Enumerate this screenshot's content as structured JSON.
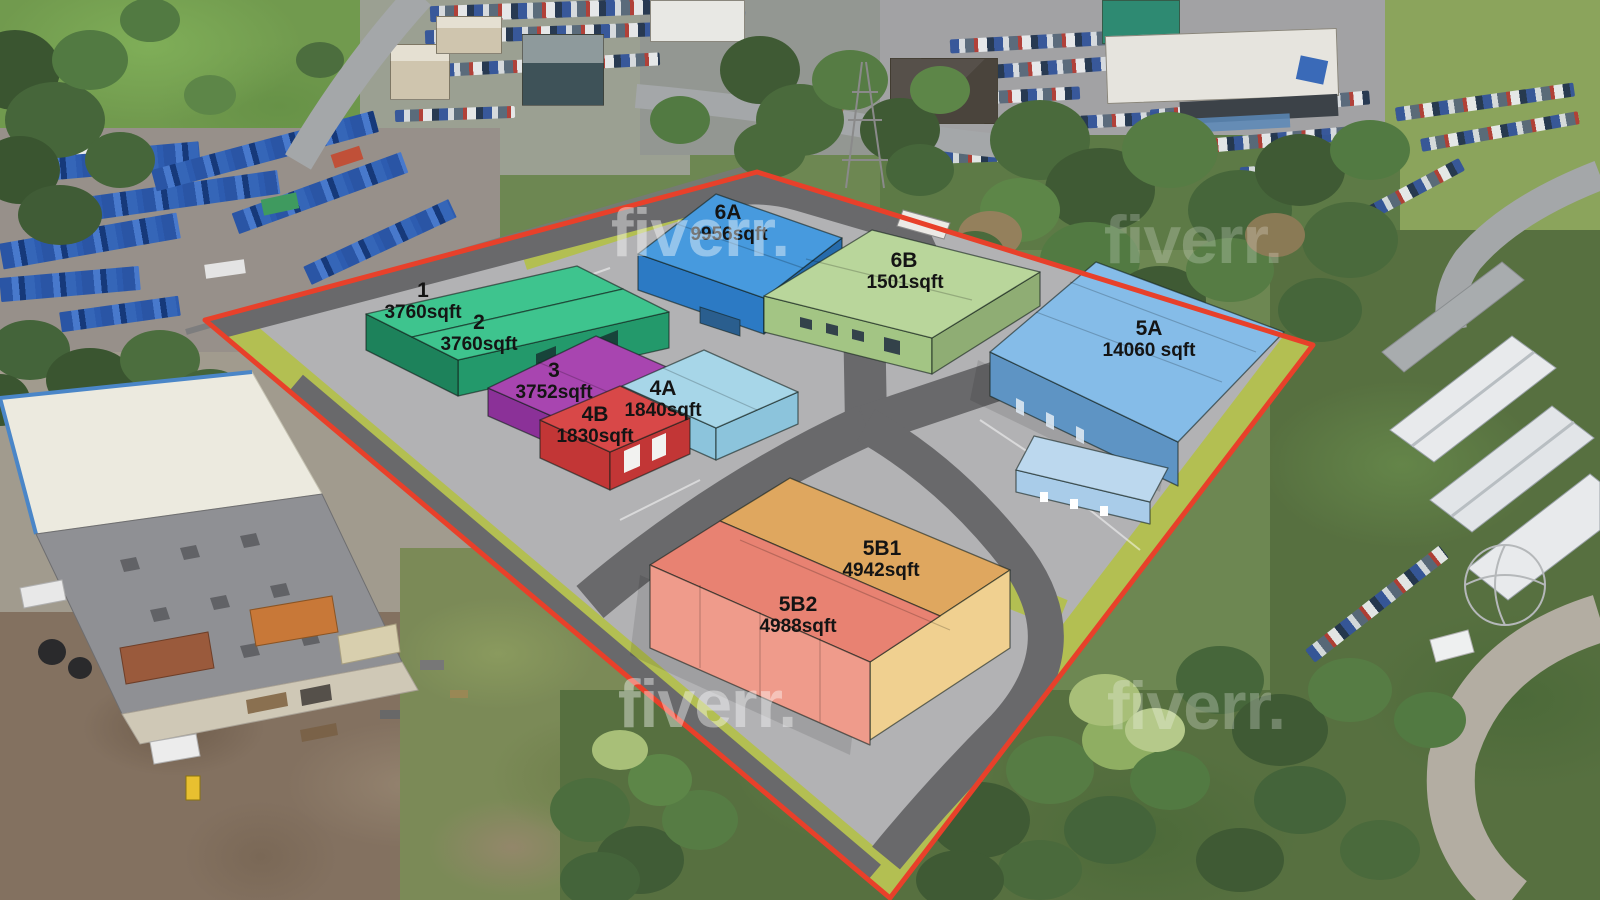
{
  "watermark": {
    "text": "fiverr."
  },
  "site_plan": {
    "boundary_color": "#e8402a",
    "road_color": "#69696b",
    "apron_color": "#b2b2b4",
    "landscaping_color": "#b3bf52",
    "label_color": "#141414",
    "units": [
      {
        "id": "1",
        "area": "3760sqft",
        "roof": "#3ec48e",
        "wall": "#23996b"
      },
      {
        "id": "2",
        "area": "3760sqft",
        "roof": "#3ec48e",
        "wall": "#23996b"
      },
      {
        "id": "3",
        "area": "3752sqft",
        "roof": "#a845b0",
        "wall": "#8b3198"
      },
      {
        "id": "4A",
        "area": "1840sqft",
        "roof": "#a7d6e8",
        "wall": "#8cc4dc"
      },
      {
        "id": "4B",
        "area": "1830sqft",
        "roof": "#d84848",
        "wall": "#c23636"
      },
      {
        "id": "5A",
        "area": "14060  sqft",
        "roof": "#85bce8",
        "wall": "#5e94c4"
      },
      {
        "id": "5B1",
        "area": "4942sqft",
        "roof": "#dfa75f",
        "wall": "#f0d090"
      },
      {
        "id": "5B2",
        "area": "4988sqft",
        "roof": "#e88272",
        "wall": "#ef9b8b"
      },
      {
        "id": "6A",
        "area": "9956sqft",
        "roof": "#479ade",
        "wall": "#2c7ac4"
      },
      {
        "id": "6B",
        "area": "1501sqft",
        "roof": "#b9d69b",
        "wall": "#a3c584"
      }
    ]
  }
}
